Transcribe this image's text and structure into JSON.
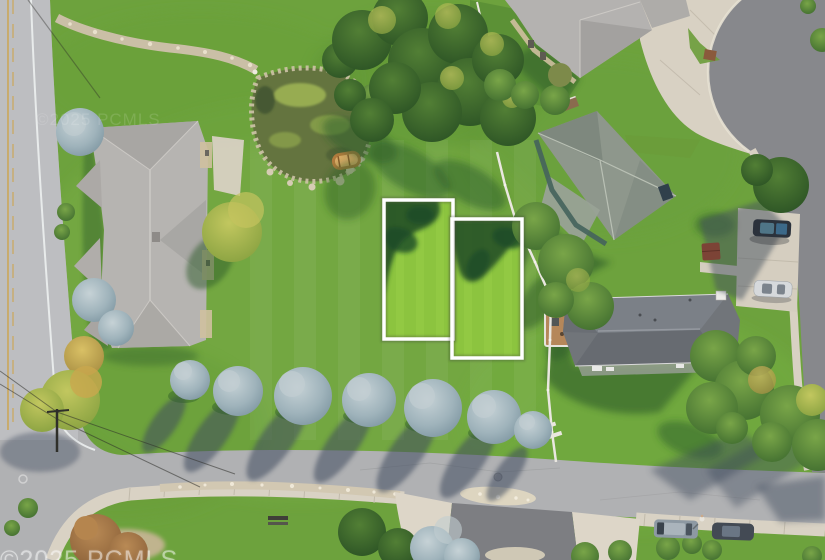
{
  "meta": {
    "type": "aerial-photograph",
    "subject": "overhead drone photo of residential neighborhood; vacant grass lot with two adjacent parcels outlined in white",
    "canvas": {
      "width": 825,
      "height": 560
    }
  },
  "watermark": {
    "text": "©2025 PCMLS",
    "color": "#ffffff"
  },
  "lot_outlines": {
    "count": 2,
    "stroke_color": "#ffffff",
    "items": [
      {
        "label": "parcel-outline-left"
      },
      {
        "label": "parcel-outline-right"
      }
    ]
  },
  "palette": {
    "lawn": "#6da23d",
    "lawn_bright_lot": "#8cc43f",
    "tree_shadow_on_lawn": "#2e5d28",
    "tree_shadow_on_road": "#3f4c5f",
    "road_light": "#b5b6b8",
    "asphalt_dark": "#87888c",
    "concrete": "#d8d1c3",
    "roof_light_gray": "#b6b4b1",
    "roof_green_gray": "#8e978c",
    "roof_dark_gray": "#71757a",
    "blue_spruce": "#8da4ae",
    "pond_water": "#64743f",
    "boat_wood": "#b07b3e",
    "fence_white": "#eae7e0"
  }
}
